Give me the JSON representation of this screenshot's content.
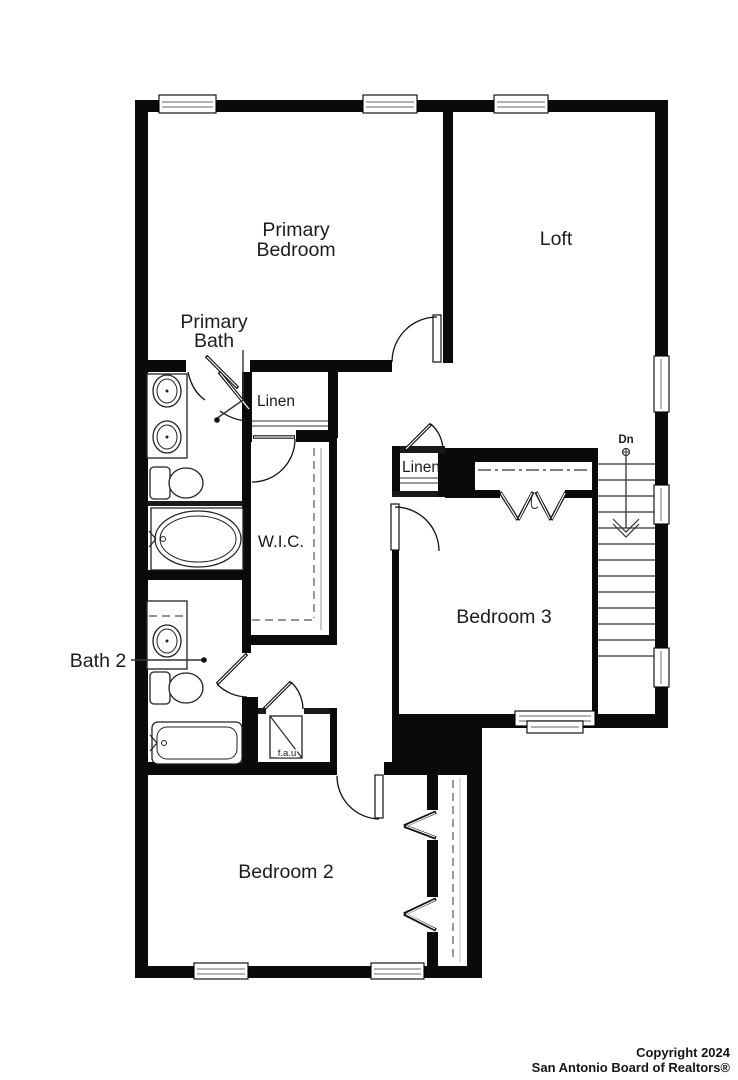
{
  "floor_plan": {
    "labels": {
      "primary_bedroom_line1": "Primary",
      "primary_bedroom_line2": "Bedroom",
      "loft": "Loft",
      "primary_bath_line1": "Primary",
      "primary_bath_line2": "Bath",
      "linen_upper": "Linen",
      "wic": "W.I.C.",
      "linen_lower": "Linen",
      "bath2": "Bath 2",
      "bedroom3": "Bedroom 3",
      "bedroom2": "Bedroom 2",
      "fau": "f.a.u",
      "stairs_direction": "Dn"
    },
    "colors": {
      "wall": "#0a0a0a",
      "background": "#ffffff",
      "text": "#1c1c1c",
      "window_line": "#9a9a9a"
    }
  },
  "footer": {
    "copyright_line1": "Copyright 2024",
    "copyright_line2": "San Antonio Board of Realtors®"
  }
}
